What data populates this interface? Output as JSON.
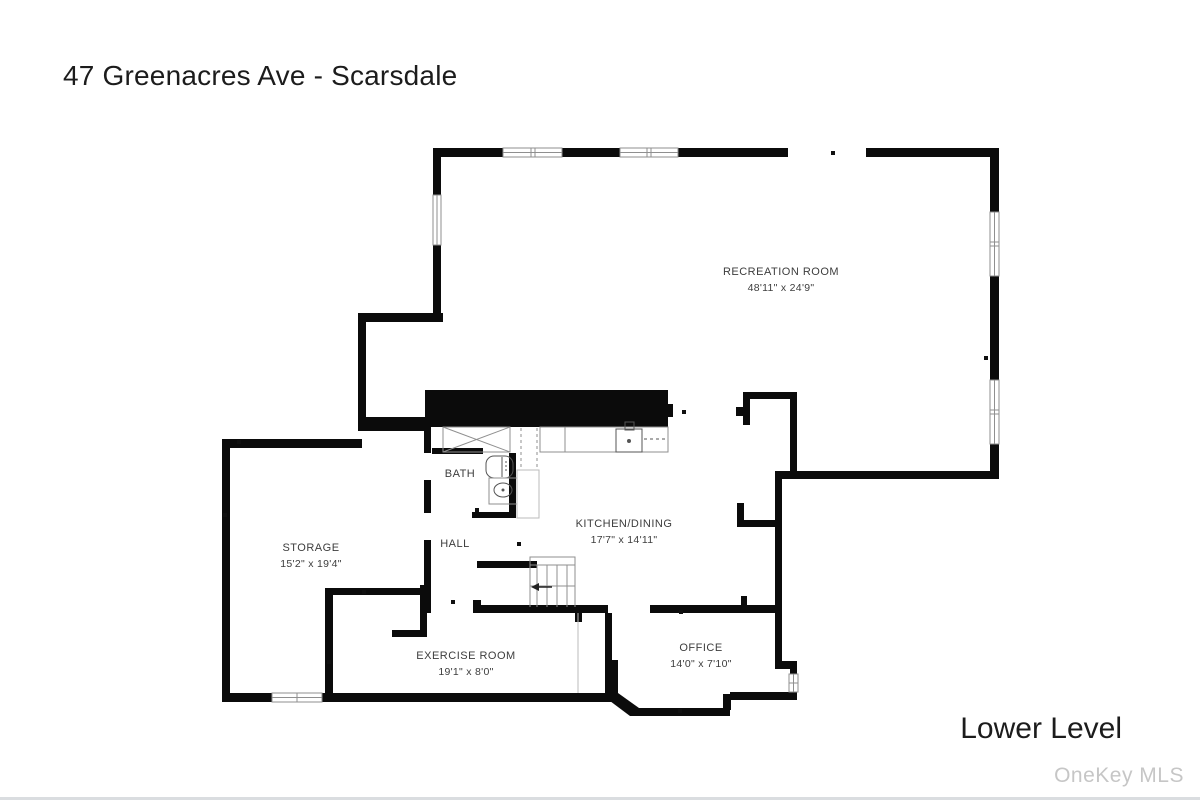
{
  "header": {
    "title": "47 Greenacres Ave - Scarsdale"
  },
  "footer": {
    "level_label": "Lower Level",
    "watermark": "OneKey MLS"
  },
  "rooms": {
    "recreation": {
      "name": "RECREATION ROOM",
      "dims": "48'11\" x 24'9\""
    },
    "storage": {
      "name": "STORAGE",
      "dims": "15'2\" x 19'4\""
    },
    "bath": {
      "name": "BATH"
    },
    "hall": {
      "name": "HALL"
    },
    "kitchen_dining": {
      "name": "KITCHEN/DINING",
      "dims": "17'7\" x 14'11\""
    },
    "exercise": {
      "name": "EXERCISE ROOM",
      "dims": "19'1\" x 8'0\""
    },
    "office": {
      "name": "OFFICE",
      "dims": "14'0\" x 7'10\""
    }
  },
  "colors": {
    "wall": "#0b0b0b",
    "line": "#8f8f8f",
    "line_dark": "#555555",
    "text": "#3d3d3d",
    "watermark": "#c6c6c6"
  }
}
